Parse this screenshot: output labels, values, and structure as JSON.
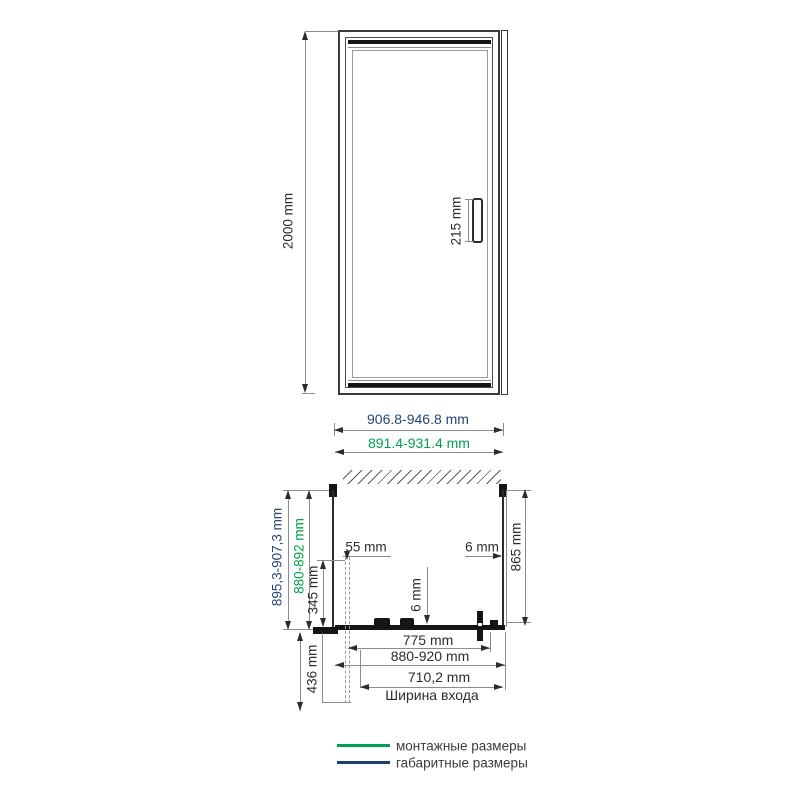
{
  "title": "shower-door-technical-drawing",
  "colors": {
    "mounting_green": "#00a04e",
    "overall_navy": "#274573",
    "drawing_dark": "#2c2c2c",
    "dimension_gray": "#8c8c8c"
  },
  "front_view": {
    "height_dim": "2000 mm",
    "handle_dim": "215 mm"
  },
  "plan_view": {
    "overall_width": "906.8-946.8 mm",
    "mounting_width": "891.4-931.4 mm",
    "overall_depth": "895,3-907,3 mm",
    "mounting_depth": "880-892 mm",
    "dim_345": "345 mm",
    "dim_436": "436 mm",
    "dim_55": "55 mm",
    "wall_gap_6": "6 mm",
    "glass_6": "6 mm",
    "depth_865": "865 mm",
    "dim_775": "775 mm",
    "dim_880_920": "880-920 mm",
    "entrance_value": "710,2 mm",
    "entrance_label": "Ширина входа"
  },
  "legend": {
    "items": [
      {
        "label": "монтажные размеры",
        "color": "#00a04e"
      },
      {
        "label": "габаритные размеры",
        "color": "#1e3e70"
      }
    ]
  }
}
